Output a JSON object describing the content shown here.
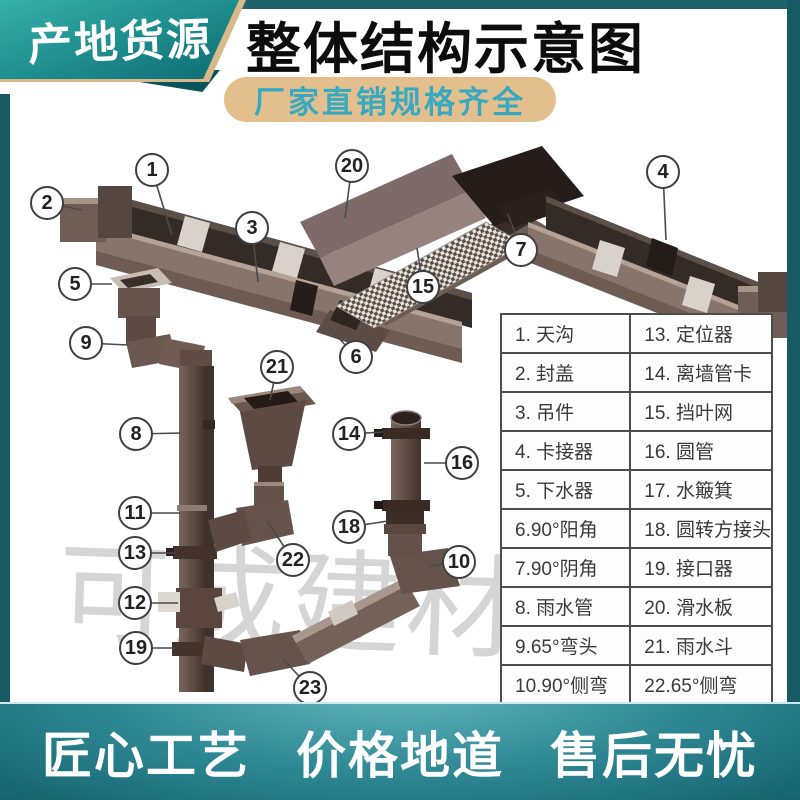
{
  "badge": {
    "label": "产地货源"
  },
  "title": {
    "text": "整体结构示意图"
  },
  "subtitle": {
    "text": "厂家直销规格齐全"
  },
  "watermark": {
    "text": "可成建材"
  },
  "footer": {
    "items": [
      "匠心工艺",
      "价格地道",
      "售后无忧"
    ]
  },
  "legend": {
    "rows": [
      {
        "left": "1. 天沟",
        "right": "13. 定位器"
      },
      {
        "left": "2. 封盖",
        "right": "14. 离墙管卡"
      },
      {
        "left": "3. 吊件",
        "right": "15. 挡叶网"
      },
      {
        "left": "4. 卡接器",
        "right": "16. 圆管"
      },
      {
        "left": "5. 下水器",
        "right": "17. 水簸箕"
      },
      {
        "left": "6.90°阳角",
        "right": "18. 圆转方接头"
      },
      {
        "left": "7.90°阴角",
        "right": "19. 接口器"
      },
      {
        "left": "8. 雨水管",
        "right": "20. 滑水板"
      },
      {
        "left": "9.65°弯头",
        "right": "21. 雨水斗"
      },
      {
        "left": "10.90°侧弯",
        "right": "22.65°侧弯"
      }
    ]
  },
  "diagram": {
    "callouts": [
      {
        "label": "1",
        "x": 152,
        "y": 170,
        "tx": 172,
        "ty": 235
      },
      {
        "label": "2",
        "x": 47,
        "y": 203,
        "tx": 82,
        "ty": 210
      },
      {
        "label": "3",
        "x": 252,
        "y": 228,
        "tx": 258,
        "ty": 282
      },
      {
        "label": "4",
        "x": 663,
        "y": 172,
        "tx": 666,
        "ty": 240
      },
      {
        "label": "5",
        "x": 75,
        "y": 284,
        "tx": 112,
        "ty": 284
      },
      {
        "label": "6",
        "x": 356,
        "y": 357,
        "tx": 328,
        "ty": 326
      },
      {
        "label": "7",
        "x": 521,
        "y": 250,
        "tx": 508,
        "ty": 214
      },
      {
        "label": "8",
        "x": 136,
        "y": 434,
        "tx": 181,
        "ty": 433
      },
      {
        "label": "9",
        "x": 86,
        "y": 343,
        "tx": 128,
        "ty": 345
      },
      {
        "label": "10",
        "x": 459,
        "y": 562,
        "tx": 430,
        "ty": 566
      },
      {
        "label": "11",
        "x": 135,
        "y": 513,
        "tx": 181,
        "ty": 513
      },
      {
        "label": "12",
        "x": 135,
        "y": 603,
        "tx": 178,
        "ty": 603
      },
      {
        "label": "13",
        "x": 135,
        "y": 553,
        "tx": 176,
        "ty": 553
      },
      {
        "label": "14",
        "x": 349,
        "y": 434,
        "tx": 383,
        "ty": 432
      },
      {
        "label": "15",
        "x": 423,
        "y": 287,
        "tx": 417,
        "ty": 248
      },
      {
        "label": "16",
        "x": 462,
        "y": 463,
        "tx": 424,
        "ty": 463
      },
      {
        "label": "18",
        "x": 349,
        "y": 527,
        "tx": 388,
        "ty": 521
      },
      {
        "label": "19",
        "x": 136,
        "y": 648,
        "tx": 175,
        "ty": 648
      },
      {
        "label": "20",
        "x": 352,
        "y": 166,
        "tx": 345,
        "ty": 218
      },
      {
        "label": "21",
        "x": 277,
        "y": 367,
        "tx": 270,
        "ty": 400
      },
      {
        "label": "22",
        "x": 293,
        "y": 560,
        "tx": 267,
        "ty": 521
      },
      {
        "label": "23",
        "x": 310,
        "y": 688,
        "tx": 283,
        "ty": 659
      }
    ]
  },
  "colors": {
    "teal_banner": "#1d8b8c",
    "teal_dark_frame": "#175a63",
    "gold_edge": "#d9b98a",
    "pill_bg": "#e3bf8d",
    "pill_text": "#39a9c2",
    "footer_teal": "#2d8793",
    "gutter_brown": "#87756b",
    "gutter_dark": "#342a26",
    "watermark_gray": "#d5d5d5"
  }
}
